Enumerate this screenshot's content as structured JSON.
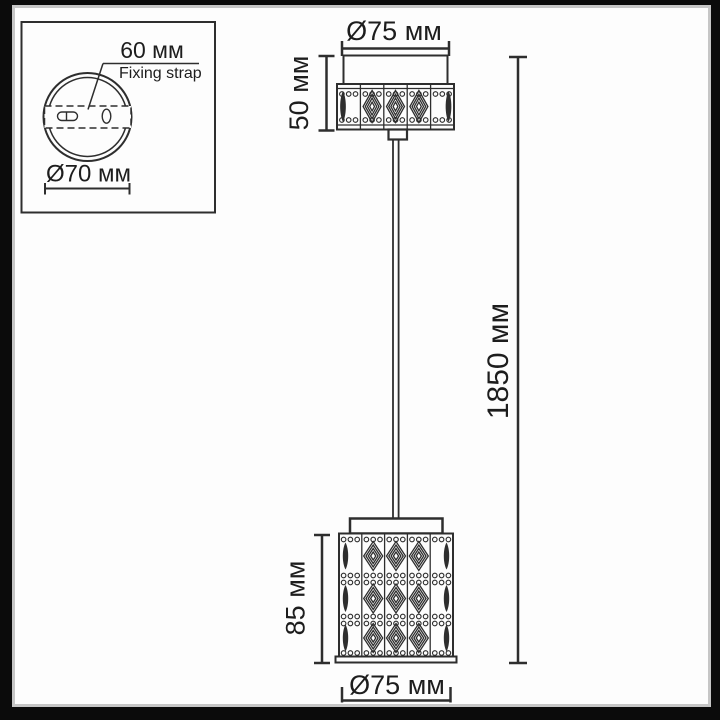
{
  "frame": {
    "background": "#fdfdfd",
    "border_color": "#0b0b0b",
    "accent_color": "#c6c6c6",
    "line_color": "#2e2e2e"
  },
  "inset": {
    "strap_width_label": "60 мм",
    "strap_name_label": "Fixing strap",
    "plate_diameter_label": "Ø70 мм"
  },
  "pendant": {
    "canopy_diameter_label": "Ø75 мм",
    "canopy_height_label": "50 мм",
    "overall_height_label": "1850 мм",
    "shade_height_label": "85 мм",
    "shade_diameter_label": "Ø75 мм"
  }
}
